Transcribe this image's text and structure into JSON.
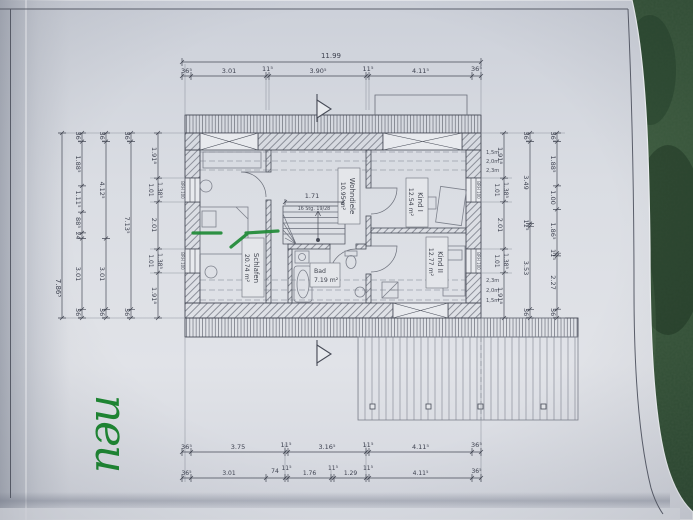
{
  "photo": {
    "note": "neu",
    "colors": {
      "paper": "#dcdfe5",
      "fabric_green": "#2f4c33",
      "annotation_green": "#1f8a36",
      "print_ink": "#474b57"
    }
  },
  "plan": {
    "rooms": {
      "schlafen": {
        "name": "Schlafen",
        "area": "20.74 m²"
      },
      "wohndiele": {
        "name": "Wohndiele",
        "area": "10.95 m²"
      },
      "kind1": {
        "name": "Kind I",
        "area": "12.54 m²"
      },
      "kind2": {
        "name": "Kind II",
        "area": "12.77 m²"
      },
      "bad": {
        "name": "Bad",
        "area": "7.19 m²"
      }
    },
    "stairs": {
      "label": "16 Stg. 19/28",
      "width": "1.71"
    },
    "window_sill_label": "BRH 100",
    "height_marks": {
      "top": [
        "1,5m",
        "2,0m",
        "2,3m"
      ],
      "bottom": [
        "2,3m",
        "2,0m",
        "1,5m"
      ]
    }
  },
  "dimensions": {
    "top": {
      "total": "11.99",
      "chain": [
        "36⁵",
        "3.01",
        "11⁵",
        "3.90⁵",
        "11⁵",
        "4.11⁵",
        "36⁵"
      ]
    },
    "bottom": {
      "upper": [
        "36⁵",
        "3.75",
        "11⁵",
        "3.16⁵",
        "11⁵",
        "4.11⁵",
        "36⁵"
      ],
      "lower": [
        "36⁵",
        "3.01",
        "74",
        "11⁵",
        "1.76",
        "11⁵",
        "1.29",
        "11⁵",
        "4.11⁵",
        "36⁵"
      ]
    },
    "left": {
      "total": "7.86⁵",
      "chain_a": [
        "36⁵",
        "1.88⁵",
        "1.11⁵",
        "88⁵",
        "24",
        "3.01",
        "36⁵"
      ],
      "chain_b": [
        "36⁵",
        "4.12⁵",
        "3.01",
        "36⁵"
      ],
      "chain_c": [
        "36⁵",
        "7.13⁵",
        "36⁵"
      ],
      "windows": [
        "1.91⁸",
        "1.01",
        "1.38⁵",
        "2.01",
        "1.01",
        "1.38⁵",
        "1.91⁸"
      ]
    },
    "right": {
      "windows": [
        "1.91⁸",
        "1.01",
        "1.38⁵",
        "2.01",
        "1.01",
        "1.38⁵",
        "1.91⁸"
      ],
      "chain_b": [
        "36⁵",
        "3.49",
        "11⁵",
        "3.53",
        "36⁵"
      ],
      "chain_c": [
        "36⁵",
        "1.88⁵",
        "1.00",
        "1.86⁵",
        "11⁵",
        "2.27",
        "36⁵"
      ]
    }
  }
}
